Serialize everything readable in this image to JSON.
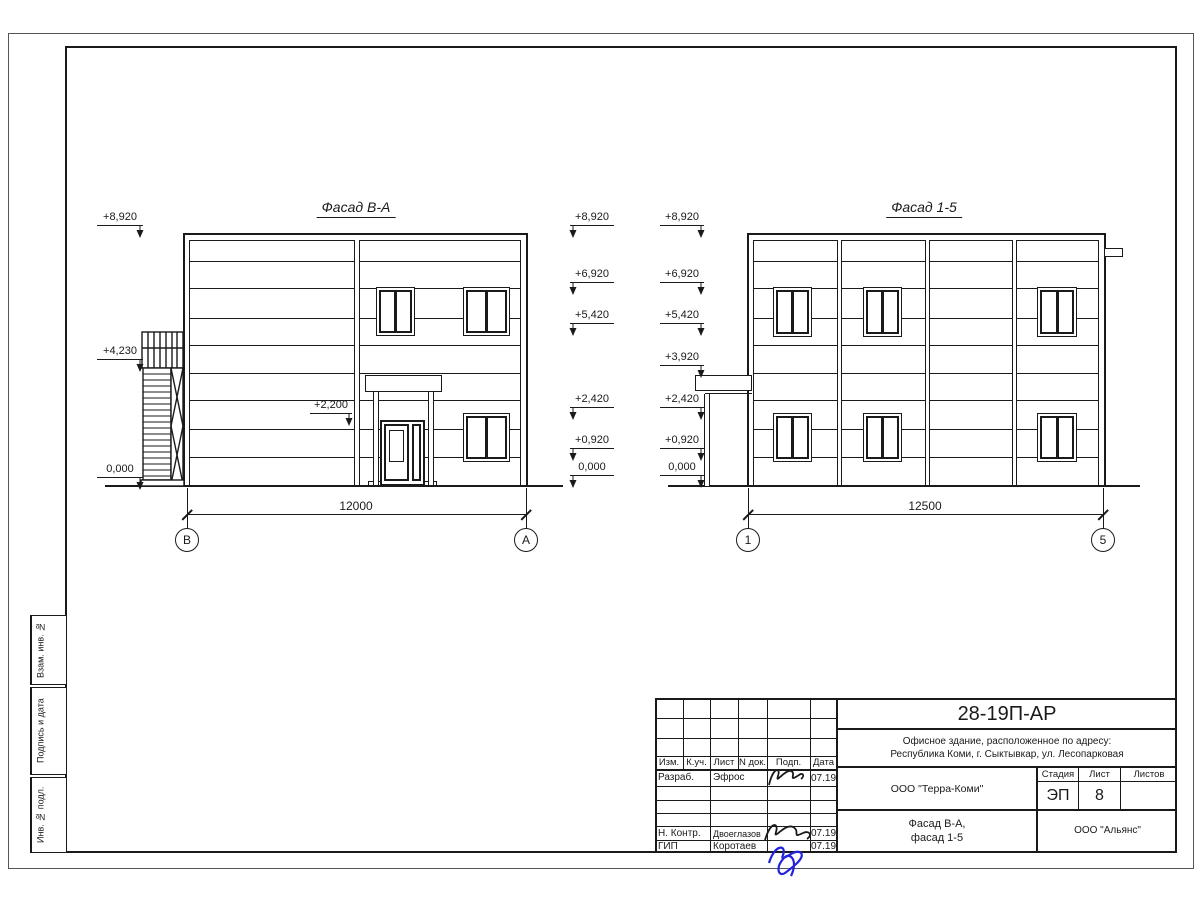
{
  "sidebar": {
    "boxes": [
      {
        "label": "Взам. инв. №"
      },
      {
        "label": "Подпись и дата"
      },
      {
        "label": "Инв. № подл."
      }
    ]
  },
  "drawing": {
    "facade_ba": {
      "title": "Фасад В-А",
      "dimension": "12000",
      "axis_left": "В",
      "axis_right": "А",
      "marks_left": [
        "+8,920",
        "+4,230",
        "0,000"
      ],
      "marks_right": [
        "+8,920",
        "+6,920",
        "+5,420",
        "+2,420",
        "+0,920",
        "0,000"
      ],
      "mark_entrance": "+2,200"
    },
    "facade_15": {
      "title": "Фасад 1-5",
      "dimension": "12500",
      "axis_left": "1",
      "axis_right": "5",
      "marks_left": [
        "+8,920",
        "+6,920",
        "+5,420",
        "+3,920",
        "+2,420",
        "+0,920",
        "0,000"
      ]
    }
  },
  "stamp": {
    "headers": {
      "izm": "Изм.",
      "kuch": "К.уч.",
      "list": "Лист",
      "ndok": "N док.",
      "podp": "Подп.",
      "data": "Дата"
    },
    "rows": {
      "razrab_label": "Разраб.",
      "razrab_name": "Эфрос",
      "razrab_date": "07.19",
      "nkontr_label": "Н. Контр.",
      "nkontr_name": "Двоеглазов",
      "nkontr_date": "07.19",
      "gip_label": "ГИП",
      "gip_name": "Коротаев",
      "gip_date": "07.19"
    },
    "code": "28-19П-АР",
    "address_line1": "Офисное здание, расположенное по адресу:",
    "address_line2": "Республика Коми, г. Сыктывкар, ул. Лесопарковая",
    "org1": "ООО \"Терра-Коми\"",
    "stage_header": "Стадия",
    "list_header": "Лист",
    "listov_header": "Листов",
    "stage_value": "ЭП",
    "list_value": "8",
    "doc_title_line1": "Фасад В-А,",
    "doc_title_line2": "фасад 1-5",
    "org2": "ООО \"Альянс\""
  }
}
